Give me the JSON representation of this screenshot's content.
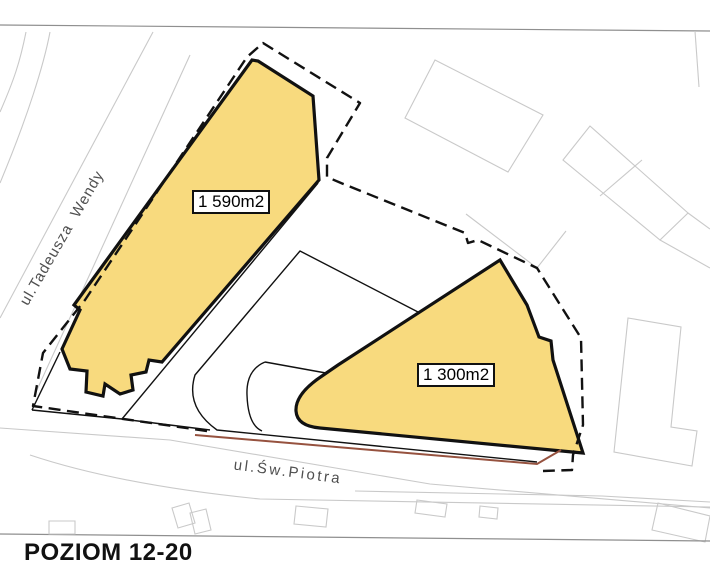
{
  "page": {
    "level_label": "POZIOM 12-20"
  },
  "plan": {
    "streets": [
      {
        "name": "ul.Tadeusza  Wendy"
      },
      {
        "name": "ul.Św.Piotra"
      }
    ],
    "buildings": [
      {
        "area_label": "1 590m2"
      },
      {
        "area_label": "1 300m2"
      }
    ],
    "colors": {
      "building_fill": "#F8DA7E",
      "outline_black": "#111111",
      "context_line": "#c9c9c9",
      "frame_line": "#8f8f8f",
      "street_text": "#4f4f4f",
      "property_line": "#96523F"
    }
  }
}
